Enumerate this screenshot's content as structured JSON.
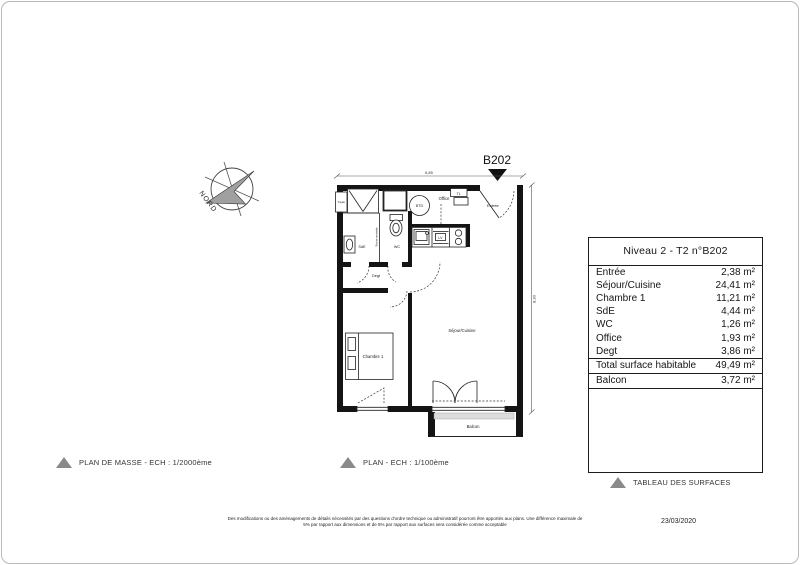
{
  "compass": {
    "label": "NORD"
  },
  "plan": {
    "unit_marker": "B202",
    "dimensions": {
      "width": "6,85",
      "height": "8,30"
    },
    "rooms": {
      "entree": "Entrée",
      "sejour_cuisine": "Séjour/Cuisine",
      "chambre": "Chambre 1",
      "sde": "SdE",
      "wc": "WC",
      "office": "Office",
      "degt": "Degt",
      "balcon": "Balcon",
      "tuyau": "Tuyau",
      "seche_serviette": "Sèche-serviette"
    },
    "fixtures": {
      "btd": "BTD",
      "tl": "TL",
      "lv": "LV"
    }
  },
  "surface_table": {
    "title": "Niveau 2 - T2 n°B202",
    "rows": [
      {
        "label": "Entrée",
        "value": "2,38 m²"
      },
      {
        "label": "Séjour/Cuisine",
        "value": "24,41 m²"
      },
      {
        "label": "Chambre 1",
        "value": "11,21 m²"
      },
      {
        "label": "SdE",
        "value": "4,44 m²"
      },
      {
        "label": "WC",
        "value": "1,26 m²"
      },
      {
        "label": "Office",
        "value": "1,93 m²"
      },
      {
        "label": "Degt",
        "value": "3,86 m²"
      }
    ],
    "total": {
      "label": "Total surface habitable",
      "value": "49,49 m²"
    },
    "balcony": {
      "label": "Balcon",
      "value": "3,72 m²"
    }
  },
  "legends": [
    {
      "label": "PLAN DE MASSE - ECH : 1/2000ème"
    },
    {
      "label": "PLAN - ECH : 1/100ème"
    },
    {
      "label": "TABLEAU DES SURFACES"
    }
  ],
  "footer": {
    "disclaimer_line1": "Des modifications ou des aménagements de détails nécessités par des questions d'ordre technique ou administratif pourront être apportés aux plans. Une différence maximale de",
    "disclaimer_line2": "5% par rapport aux dimensions et de 5% par rapport aux surfaces sera considérée comme acceptable",
    "date": "23/03/2020"
  },
  "colors": {
    "wall": "#141414",
    "legend_triangle": "#8a8a8a",
    "compass_arrow": "#a0a0a0",
    "page_border": "#b9b9b9"
  }
}
